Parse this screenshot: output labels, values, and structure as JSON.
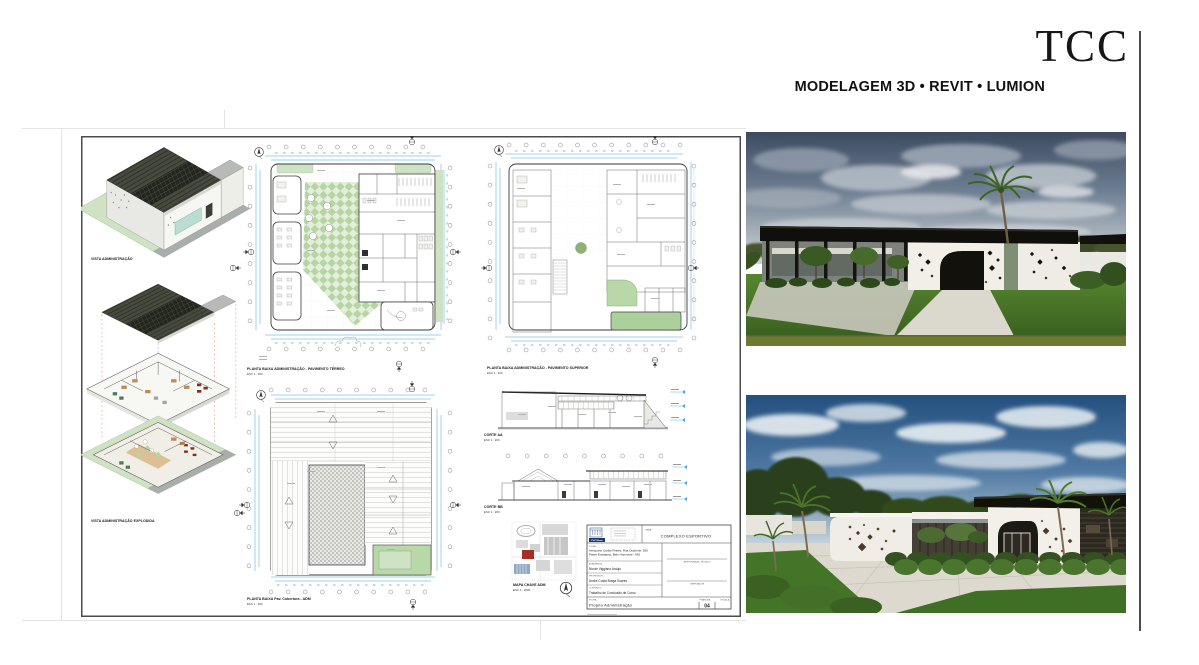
{
  "header": {
    "title": "TCC",
    "subtitle": "MODELAGEM 3D • REVIT • LUMION"
  },
  "sheet": {
    "axon_top_label": "VISTA ADMINISTRAÇÃO",
    "axon_bottom_label": "VISTA ADMINISTRAÇÃO EXPLODIDA",
    "plan_terreo_title": "PLANTA BAIXA ADMINISTRAÇÃO -  PAVIMENTO TÉRREO",
    "plan_terreo_scale": "ESC 1 : 200",
    "plan_superior_title": "PLANTA BAIXA ADMINISTRAÇÃO -  PAVIMENTO SUPERIOR",
    "plan_superior_scale": "ESC 1 : 200",
    "plan_cobertura_title": "PLANTA BAIXA Pav. Cobertura - ADM",
    "plan_cobertura_scale": "ESC 1 : 200",
    "corte_aa_title": "CORTE AA",
    "corte_aa_scale": "ESC 1 : 200",
    "corte_bb_title": "CORTE BB",
    "corte_bb_scale": "ESC 1 : 200",
    "mapa_title": "MAPA CHAVE ADM",
    "mapa_scale": "ESC 1 : 2000",
    "titleblock": {
      "logo_text": "PUC Minas",
      "obra_label": "OBRA",
      "obra": "COMPLEXO ESPORTIVO",
      "local_label": "LOCAL",
      "address_line1": "Aeroporto Carlos Prates, Rua Ocidente, 180",
      "address_line2": "Padre Eustáquio, Belo Horizonte - MG",
      "academico_label": "ACADÊMICA",
      "academico": "Nicole Viggiano Araújo",
      "professor_label": "PROFESSOR",
      "professor": "André Costa Braga Soares",
      "conteudo_label": "CONTEÚDO",
      "conteudo": "Trabalho de Conclusão de Curso",
      "folha_label": "FOLHA",
      "folha": "Projeto Administração",
      "assinatura_label": "RESPONSÁVEL TÉCNICO",
      "orientador_label": "ORIENTADOR",
      "prancha_label": "PRANCHA",
      "escala_label": "ESCALA",
      "numero": "04"
    }
  },
  "colors": {
    "dimension_blue": "#41a5e1",
    "plan_green": "#cfe3c4",
    "courtyard_green": "#b7d4a4",
    "roof_dark": "#474b3f",
    "site_highlight_red": "#a33028",
    "render_sky_blue": "#24507f",
    "render_grass_green": "#4a7a2c",
    "accent_black": "#121110"
  }
}
